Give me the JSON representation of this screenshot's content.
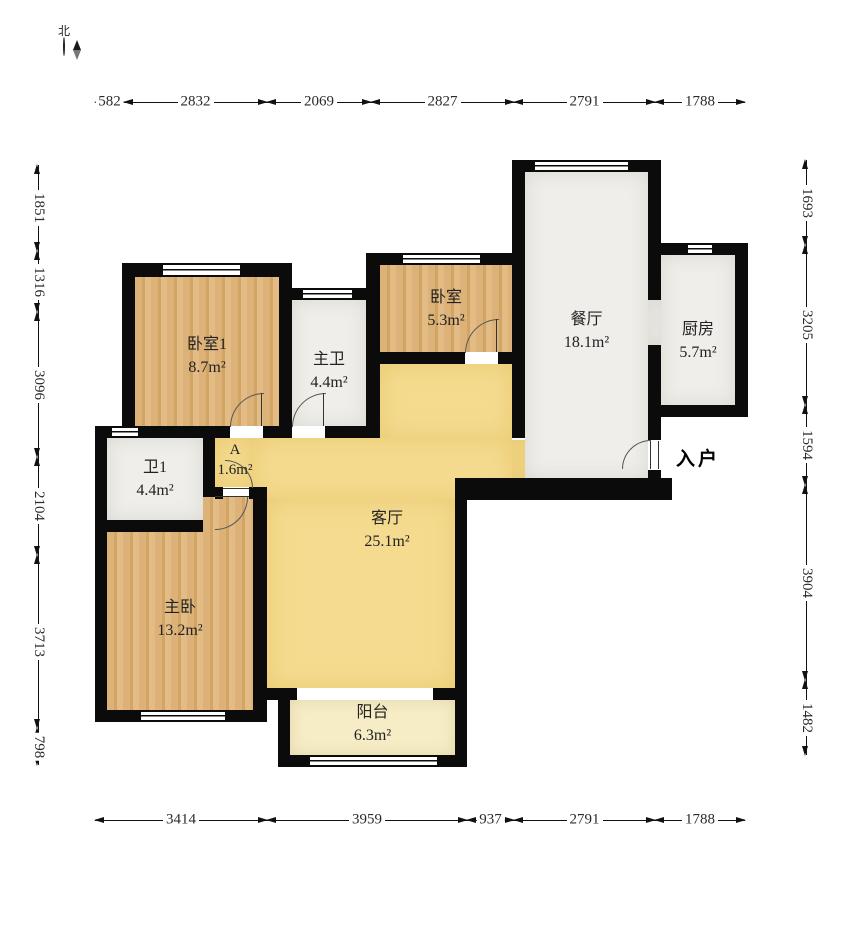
{
  "compass": {
    "north_label": "北"
  },
  "entry_label": "入户",
  "dims": {
    "top": [
      "582",
      "2832",
      "2069",
      "2827",
      "2791",
      "1788"
    ],
    "bottom": [
      "3414",
      "3959",
      "937",
      "2791",
      "1788"
    ],
    "left": [
      "1851",
      "1316",
      "3096",
      "2104",
      "3713",
      "798"
    ],
    "right": [
      "1693",
      "3205",
      "1594",
      "3904",
      "1482"
    ]
  },
  "rooms": {
    "bedroom1": {
      "name": "卧室1",
      "area": "8.7m²"
    },
    "master_bath": {
      "name": "主卫",
      "area": "4.4m²"
    },
    "bedroom2": {
      "name": "卧室",
      "area": "5.3m²"
    },
    "dining": {
      "name": "餐厅",
      "area": "18.1m²"
    },
    "kitchen": {
      "name": "厨房",
      "area": "5.7m²"
    },
    "bath1": {
      "name": "卫1",
      "area": "4.4m²"
    },
    "closet_a": {
      "name": "A",
      "area": "1.6m²"
    },
    "master_bedroom": {
      "name": "主卧",
      "area": "13.2m²"
    },
    "living": {
      "name": "客厅",
      "area": "25.1m²"
    },
    "balcony": {
      "name": "阳台",
      "area": "6.3m²"
    }
  },
  "colors": {
    "wall": "#0b0b0b",
    "wood_floor": "#dcb278",
    "living_floor": "#f5db8f",
    "balcony_floor": "#f6ecc6",
    "tile_floor": "#efeeea"
  }
}
